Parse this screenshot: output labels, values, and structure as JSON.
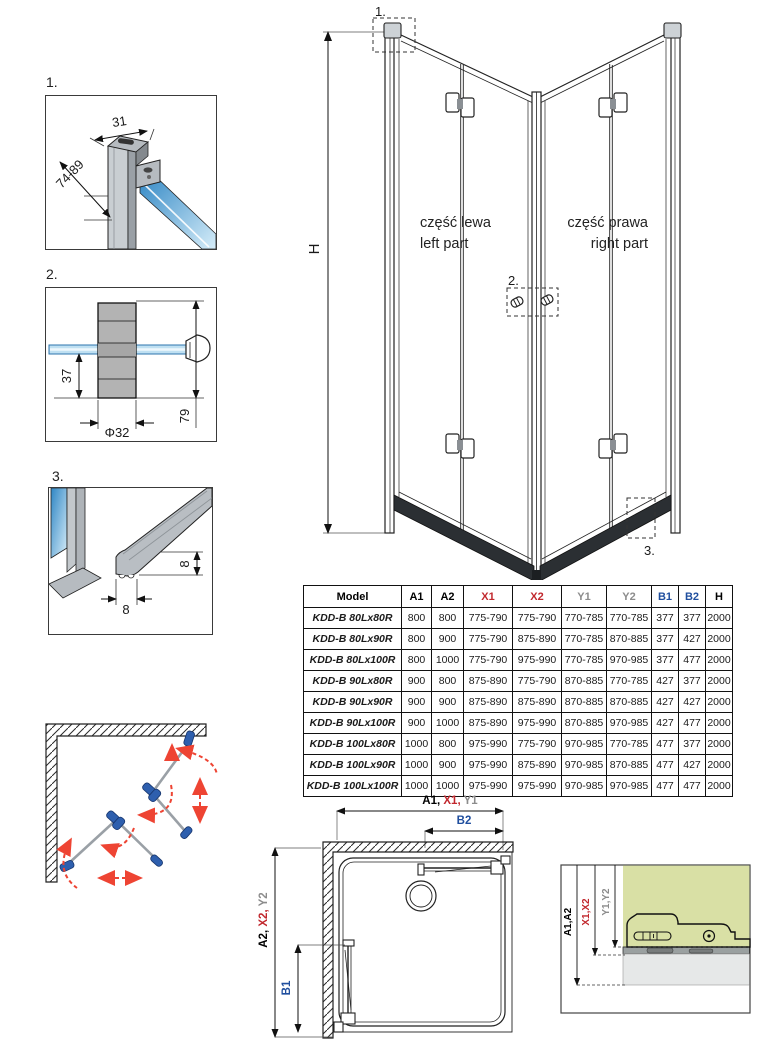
{
  "colors": {
    "dim_red": "#c1272d",
    "dim_gray": "#8c8c8c",
    "dim_blue": "#1f4e9e",
    "line_black": "#1a1a1a",
    "glass_blue_dark": "#2f86c4",
    "glass_blue_light": "#d6edf9",
    "profile_gray": "#b9bec3",
    "hinge_blue": "#2e5fae",
    "arrow_red": "#ee4433",
    "section_green": "#d9e0a5",
    "section_gray": "#e6e8e8"
  },
  "detail1": {
    "label": "1.",
    "dim_width": "31",
    "dim_range": "74-89"
  },
  "detail2": {
    "label": "2.",
    "dim_offset": "37",
    "dim_diameter": "Φ32",
    "dim_total": "79"
  },
  "detail3": {
    "label": "3.",
    "dim_height": "8",
    "dim_width": "8"
  },
  "elevation": {
    "dim_height": "H",
    "callout1": "1.",
    "callout2": "2.",
    "callout3": "3.",
    "left_part_pl": "część lewa",
    "left_part_en": "left part",
    "right_part_pl": "część prawa",
    "right_part_en": "right part"
  },
  "table": {
    "headers": [
      {
        "label": "Model",
        "color": "#000000"
      },
      {
        "label": "A1",
        "color": "#000000"
      },
      {
        "label": "A2",
        "color": "#000000"
      },
      {
        "label": "X1",
        "color": "#c1272d"
      },
      {
        "label": "X2",
        "color": "#c1272d"
      },
      {
        "label": "Y1",
        "color": "#8c8c8c"
      },
      {
        "label": "Y2",
        "color": "#8c8c8c"
      },
      {
        "label": "B1",
        "color": "#1f4e9e"
      },
      {
        "label": "B2",
        "color": "#1f4e9e"
      },
      {
        "label": "H",
        "color": "#000000"
      }
    ],
    "rows": [
      [
        "KDD-B 80Lx80R",
        "800",
        "800",
        "775-790",
        "775-790",
        "770-785",
        "770-785",
        "377",
        "377",
        "2000"
      ],
      [
        "KDD-B 80Lx90R",
        "800",
        "900",
        "775-790",
        "875-890",
        "770-785",
        "870-885",
        "377",
        "427",
        "2000"
      ],
      [
        "KDD-B 80Lx100R",
        "800",
        "1000",
        "775-790",
        "975-990",
        "770-785",
        "970-985",
        "377",
        "477",
        "2000"
      ],
      [
        "KDD-B 90Lx80R",
        "900",
        "800",
        "875-890",
        "775-790",
        "870-885",
        "770-785",
        "427",
        "377",
        "2000"
      ],
      [
        "KDD-B 90Lx90R",
        "900",
        "900",
        "875-890",
        "875-890",
        "870-885",
        "870-885",
        "427",
        "427",
        "2000"
      ],
      [
        "KDD-B 90Lx100R",
        "900",
        "1000",
        "875-890",
        "975-990",
        "870-885",
        "970-985",
        "427",
        "477",
        "2000"
      ],
      [
        "KDD-B 100Lx80R",
        "1000",
        "800",
        "975-990",
        "775-790",
        "970-985",
        "770-785",
        "477",
        "377",
        "2000"
      ],
      [
        "KDD-B 100Lx90R",
        "1000",
        "900",
        "975-990",
        "875-890",
        "970-985",
        "870-885",
        "477",
        "427",
        "2000"
      ],
      [
        "KDD-B 100Lx100R",
        "1000",
        "1000",
        "975-990",
        "975-990",
        "970-985",
        "970-985",
        "477",
        "477",
        "2000"
      ]
    ]
  },
  "plan": {
    "dim_a1": "A1, ",
    "dim_x1": "X1, ",
    "dim_y1": "Y1",
    "dim_b2": "B2",
    "dim_a2": "A2, ",
    "dim_x2": "X2, ",
    "dim_y2": "Y2",
    "dim_b1": "B1"
  },
  "section": {
    "dim_a": "A1,A2",
    "dim_x": "X1,X2",
    "dim_y": "Y1,Y2"
  }
}
